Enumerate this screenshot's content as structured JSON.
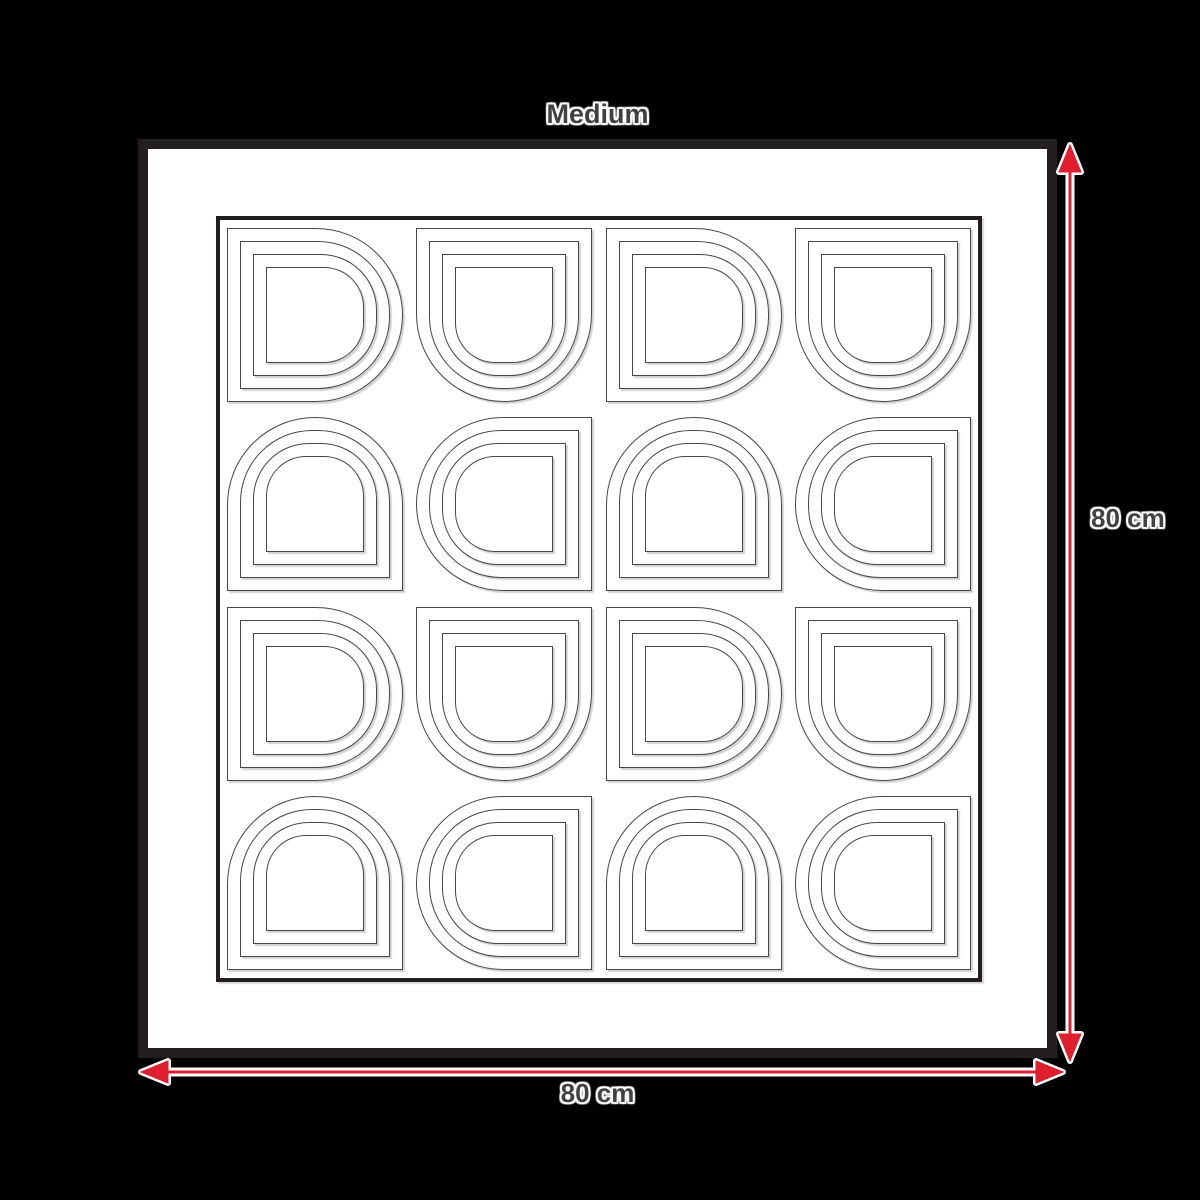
{
  "title": "Medium",
  "dimensions": {
    "height_label": "80 cm",
    "width_label": "80 cm"
  },
  "colors": {
    "background": "#000000",
    "frame": "#231f20",
    "accent_red": "#df1e2e",
    "pattern_line": "#4a4549",
    "label_text": "#414042",
    "halo": "#ffffff"
  },
  "artwork": {
    "grid_rows": 4,
    "grid_cols": 4,
    "rings_per_shape": 4,
    "ring_inset_px": 13,
    "orientations": [
      [
        "right",
        "down",
        "right",
        "down"
      ],
      [
        "up",
        "left",
        "up",
        "left"
      ],
      [
        "right",
        "down",
        "right",
        "down"
      ],
      [
        "up",
        "left",
        "up",
        "left"
      ]
    ]
  }
}
